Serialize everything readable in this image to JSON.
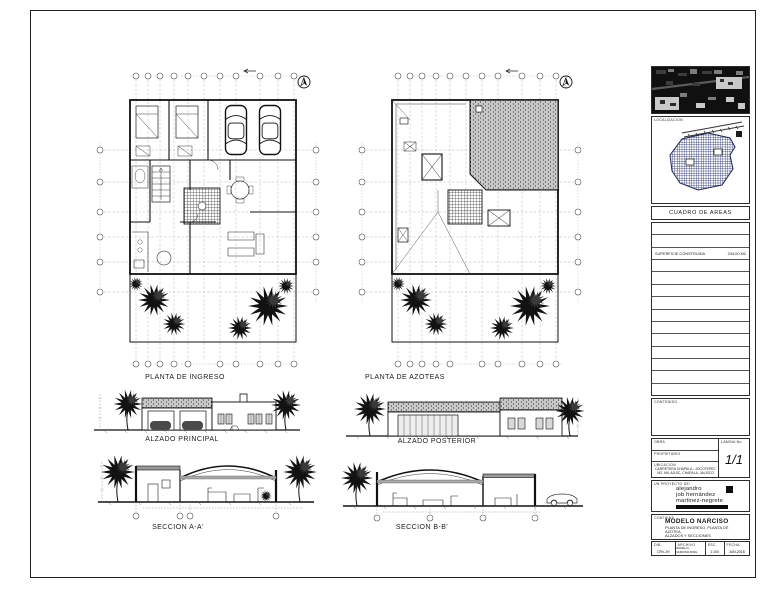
{
  "sheet": {
    "drawings": [
      {
        "id": "planta-ingreso",
        "label": "PLANTA DE INGRESO"
      },
      {
        "id": "planta-azoteas",
        "label": "PLANTA DE AZOTEAS"
      },
      {
        "id": "alzado-principal",
        "label": "ALZADO PRINCIPAL"
      },
      {
        "id": "alzado-posterior",
        "label": "ALZADO POSTERIOR"
      },
      {
        "id": "seccion-aa",
        "label": "SECCION A-A'"
      },
      {
        "id": "seccion-bb",
        "label": "SECCION B-B'"
      }
    ]
  },
  "titleblock": {
    "localizacion_label": "LOCALIZACION",
    "cuadro_header": "CUADRO DE AREAS",
    "superficie_label": "SUPERFICIE CONSTRUIDA",
    "superficie_value": "234.00 M2",
    "contenido_label": "CONTENIDO",
    "obra_label": "OBRA",
    "propietario_label": "PROPIETARIO",
    "ubicacion_label": "UBICACION",
    "ubicacion_line1": "CARRETERA CHAPALA - JOCOTEPEC",
    "ubicacion_line2": "NO. MIL AJIJIC, CHAPALA, JALISCO",
    "lamina_label": "LAMINA No.",
    "lamina_value": "1/1",
    "proyecto_label": "UN PROYECTO DE:",
    "logo_line1": "alejandro",
    "logo_line2": "job hernández",
    "logo_line3": "martinez-negrete",
    "contiene_label": "CONTIENE",
    "model_title": "MODELO NARCISO",
    "model_subtitle_1": "PLANTA DE INGRESO, PLANTA DE AZOTEA,",
    "model_subtitle_2": "ALZADOS Y SECCIONES",
    "meta_cells": [
      {
        "label": "DIB.",
        "value": "CRV-JH"
      },
      {
        "label": "ARCHIVO",
        "value": "MODELO-NARCISO.DWG"
      },
      {
        "label": "ESC.",
        "value": "1:100"
      },
      {
        "label": "FECHA",
        "value": "JUN-2018"
      }
    ]
  },
  "colors": {
    "ink": "#1a1a1a",
    "grid_gray": "#999999",
    "map_blue": "#25306b",
    "paper": "#ffffff"
  }
}
